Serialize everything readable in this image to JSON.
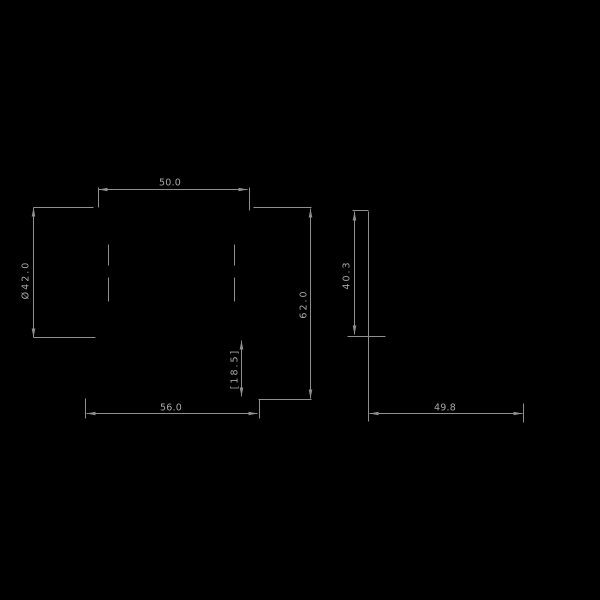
{
  "title": "Technical dimension drawing",
  "canvas": {
    "width": 600,
    "height": 600,
    "background": "#000000",
    "line_color": "#8f8f8f",
    "text_color": "#a6a6a6"
  },
  "drawing": {
    "dimension_values": [
      "50.0",
      "Ø42.0",
      "62.0",
      "[18.5]",
      "56.0",
      "49.8",
      "40.3"
    ],
    "labels": [
      {
        "name": "dim-label-50-0",
        "text": "50.0",
        "x": 170,
        "y": 183,
        "rotated": false
      },
      {
        "name": "dim-label-dia-42-0",
        "text": "Ø42.0",
        "x": 26,
        "y": 280,
        "rotated": true
      },
      {
        "name": "dim-label-62-0",
        "text": "62.0",
        "x": 304,
        "y": 304,
        "rotated": true
      },
      {
        "name": "dim-label-40-3",
        "text": "40.3",
        "x": 347,
        "y": 275,
        "rotated": true
      },
      {
        "name": "dim-label-18-5",
        "text": "[18.5]",
        "x": 235,
        "y": 369,
        "rotated": true
      },
      {
        "name": "dim-label-56-0",
        "text": "56.0",
        "x": 171,
        "y": 408,
        "rotated": false
      },
      {
        "name": "dim-label-49-8",
        "text": "49.8",
        "x": 445,
        "y": 408,
        "rotated": false
      }
    ],
    "lines": [
      {
        "name": "dim-line-50-0",
        "x1": 98,
        "y1": 189,
        "x2": 247,
        "y2": 189
      },
      {
        "name": "ext-line-50-0-left",
        "x1": 98,
        "y1": 187,
        "x2": 98,
        "y2": 207
      },
      {
        "name": "ext-line-50-0-right",
        "x1": 249,
        "y1": 187,
        "x2": 249,
        "y2": 210
      },
      {
        "name": "ext-line-42-0-top",
        "x1": 33,
        "y1": 207,
        "x2": 93,
        "y2": 207
      },
      {
        "name": "dim-line-dia-42-0",
        "x1": 33,
        "y1": 207,
        "x2": 33,
        "y2": 337
      },
      {
        "name": "ext-line-42-0-bottom",
        "x1": 33,
        "y1": 337,
        "x2": 95,
        "y2": 337
      },
      {
        "name": "ext-line-62-0-top",
        "x1": 253,
        "y1": 207,
        "x2": 311,
        "y2": 207
      },
      {
        "name": "dim-line-62-0",
        "x1": 310,
        "y1": 208,
        "x2": 310,
        "y2": 398
      },
      {
        "name": "ext-line-62-0-bottom",
        "x1": 258,
        "y1": 399,
        "x2": 311,
        "y2": 399
      },
      {
        "name": "dim-line-18-5",
        "x1": 241,
        "y1": 340,
        "x2": 241,
        "y2": 396
      },
      {
        "name": "dim-line-56-0",
        "x1": 86,
        "y1": 413,
        "x2": 257,
        "y2": 413
      },
      {
        "name": "ext-line-56-0-left",
        "x1": 85,
        "y1": 398,
        "x2": 85,
        "y2": 418
      },
      {
        "name": "ext-line-56-0-right",
        "x1": 259,
        "y1": 399,
        "x2": 259,
        "y2": 418
      },
      {
        "name": "dim-line-49-8",
        "x1": 369,
        "y1": 413,
        "x2": 522,
        "y2": 413
      },
      {
        "name": "ext-line-49-8-left",
        "x1": 368,
        "y1": 211,
        "x2": 368,
        "y2": 421
      },
      {
        "name": "ext-line-49-8-right",
        "x1": 523,
        "y1": 403,
        "x2": 523,
        "y2": 422
      },
      {
        "name": "ext-line-40-3-top",
        "x1": 352,
        "y1": 210,
        "x2": 368,
        "y2": 210
      },
      {
        "name": "dim-line-40-3",
        "x1": 354,
        "y1": 211,
        "x2": 354,
        "y2": 334
      },
      {
        "name": "ext-line-40-3-bottom",
        "x1": 347,
        "y1": 336,
        "x2": 385,
        "y2": 336
      },
      {
        "name": "centerline-left-upper-dash",
        "x1": 108,
        "y1": 244,
        "x2": 108,
        "y2": 265
      },
      {
        "name": "centerline-left-lower-dash",
        "x1": 108,
        "y1": 277,
        "x2": 108,
        "y2": 301
      },
      {
        "name": "centerline-right-upper-dash",
        "x1": 234,
        "y1": 244,
        "x2": 234,
        "y2": 265
      },
      {
        "name": "centerline-right-lower-dash",
        "x1": 234,
        "y1": 277,
        "x2": 234,
        "y2": 301
      }
    ],
    "arrows": [
      {
        "name": "arrow-50-0-left",
        "x": 98,
        "y": 189,
        "dir": "left"
      },
      {
        "name": "arrow-50-0-right",
        "x": 247,
        "y": 189,
        "dir": "right"
      },
      {
        "name": "arrow-42-0-top",
        "x": 33,
        "y": 207,
        "dir": "up"
      },
      {
        "name": "arrow-42-0-bottom",
        "x": 33,
        "y": 337,
        "dir": "down"
      },
      {
        "name": "arrow-62-0-top",
        "x": 310,
        "y": 208,
        "dir": "up"
      },
      {
        "name": "arrow-62-0-bottom",
        "x": 310,
        "y": 398,
        "dir": "down"
      },
      {
        "name": "arrow-18-5-top",
        "x": 241,
        "y": 340,
        "dir": "up"
      },
      {
        "name": "arrow-18-5-bottom",
        "x": 241,
        "y": 396,
        "dir": "down"
      },
      {
        "name": "arrow-56-0-left",
        "x": 86,
        "y": 413,
        "dir": "left"
      },
      {
        "name": "arrow-56-0-right",
        "x": 257,
        "y": 413,
        "dir": "right"
      },
      {
        "name": "arrow-49-8-left",
        "x": 369,
        "y": 413,
        "dir": "left"
      },
      {
        "name": "arrow-49-8-right",
        "x": 522,
        "y": 413,
        "dir": "right"
      },
      {
        "name": "arrow-40-3-top",
        "x": 354,
        "y": 211,
        "dir": "up"
      },
      {
        "name": "arrow-40-3-bottom",
        "x": 354,
        "y": 334,
        "dir": "down"
      }
    ]
  }
}
